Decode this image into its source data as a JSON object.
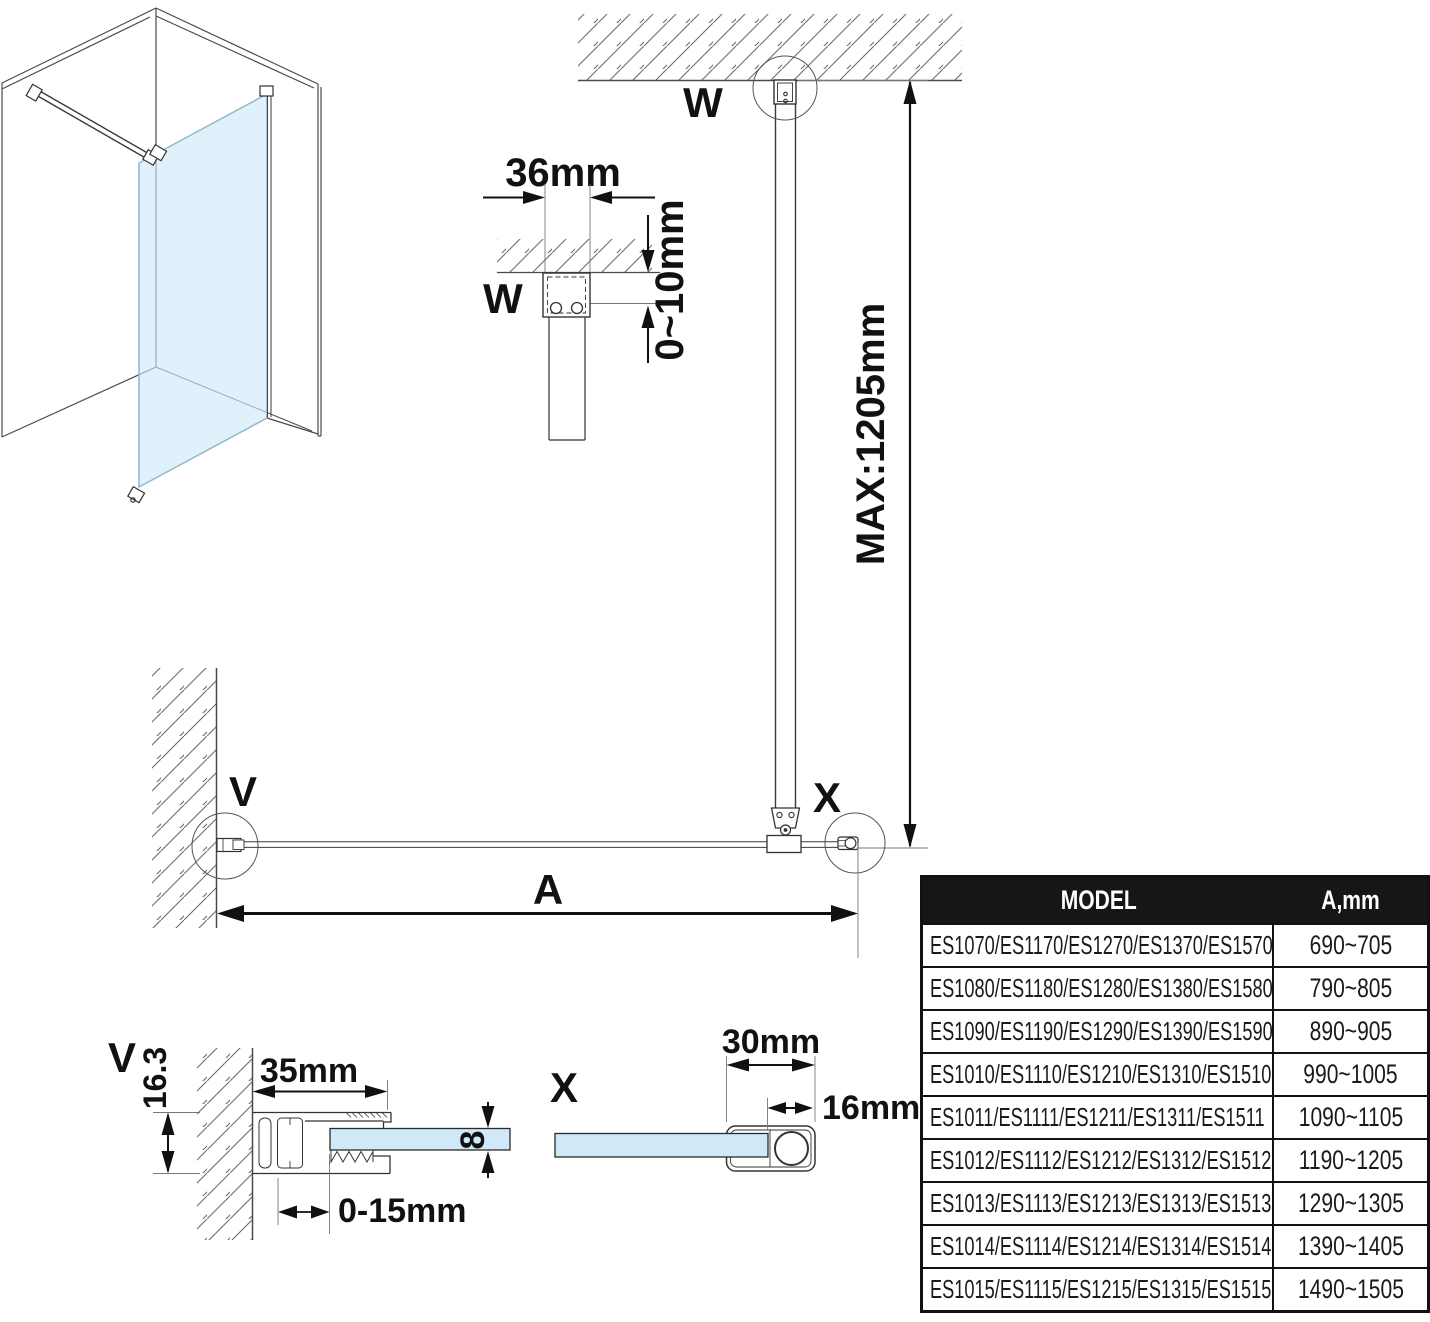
{
  "diagram": {
    "labels": {
      "w": "W",
      "v": "V",
      "x": "X",
      "a": "A",
      "dim_top_width": "36mm",
      "dim_top_gap": "0~10mm",
      "dim_max_height": "MAX:1205mm",
      "dim_wall_profile_width": "35mm",
      "dim_wall_profile_height": "16.3",
      "dim_wall_adjust": "0-15mm",
      "dim_glass_thickness": "8",
      "dim_end_cap_width": "30mm",
      "dim_end_cap_inner": "16mm"
    },
    "colors": {
      "glass": "#cfe9f8",
      "line": "#333333",
      "table_header_bg": "#161616"
    }
  },
  "table": {
    "headers": {
      "model": "MODEL",
      "a": "A,mm"
    },
    "rows": [
      {
        "model": "ES1070/ES1170/ES1270/ES1370/ES1570",
        "a": "690~705"
      },
      {
        "model": "ES1080/ES1180/ES1280/ES1380/ES1580",
        "a": "790~805"
      },
      {
        "model": "ES1090/ES1190/ES1290/ES1390/ES1590",
        "a": "890~905"
      },
      {
        "model": "ES1010/ES1110/ES1210/ES1310/ES1510",
        "a": "990~1005"
      },
      {
        "model": "ES1011/ES1111/ES1211/ES1311/ES1511",
        "a": "1090~1105"
      },
      {
        "model": "ES1012/ES1112/ES1212/ES1312/ES1512",
        "a": "1190~1205"
      },
      {
        "model": "ES1013/ES1113/ES1213/ES1313/ES1513",
        "a": "1290~1305"
      },
      {
        "model": "ES1014/ES1114/ES1214/ES1314/ES1514",
        "a": "1390~1405"
      },
      {
        "model": "ES1015/ES1115/ES1215/ES1315/ES1515",
        "a": "1490~1505"
      }
    ]
  }
}
